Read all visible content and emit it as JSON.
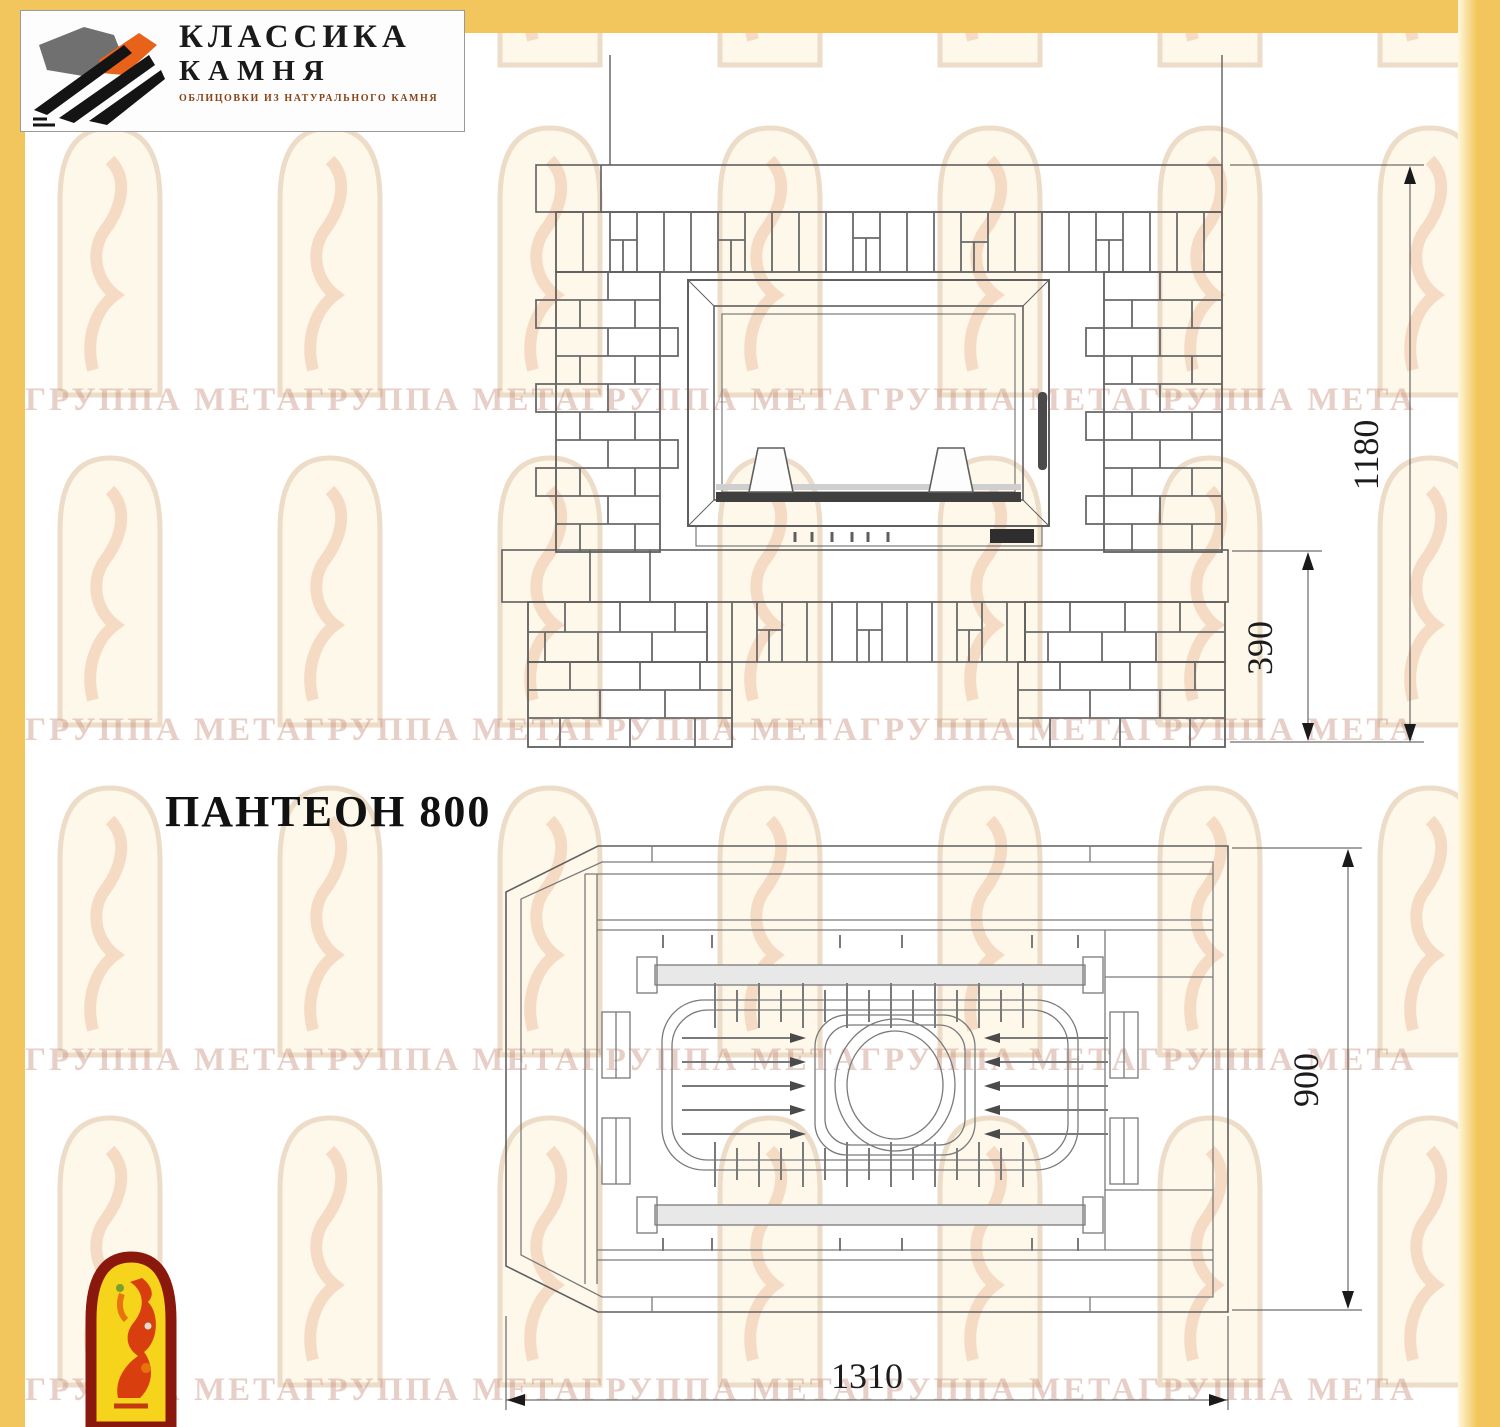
{
  "logo": {
    "line1": "КЛАССИКА",
    "line2": "КАМНЯ",
    "subtitle": "ОБЛИЦОВКИ ИЗ НАТУРАЛЬНОГО КАМНЯ"
  },
  "title": {
    "text": "ПАНТЕОН 800"
  },
  "watermark": {
    "row_text": "ГРУППА МЕТАГРУППА МЕТАГРУППА МЕТАГРУППА МЕТАГРУППА МЕТА"
  },
  "front_view": {
    "dims": {
      "height_total": "1180",
      "hearth_height": "390"
    }
  },
  "plan_view": {
    "dims": {
      "depth": "900",
      "width": "1310"
    }
  },
  "colors": {
    "page_border_yellow": "#f2c65c",
    "drawing_line_gray": "#5f5f5f",
    "emblem_red": "#8a180c",
    "emblem_yellow": "#f6d41c",
    "logo_orange": "#e8621a",
    "watermark_pink": "#c58d7d"
  }
}
